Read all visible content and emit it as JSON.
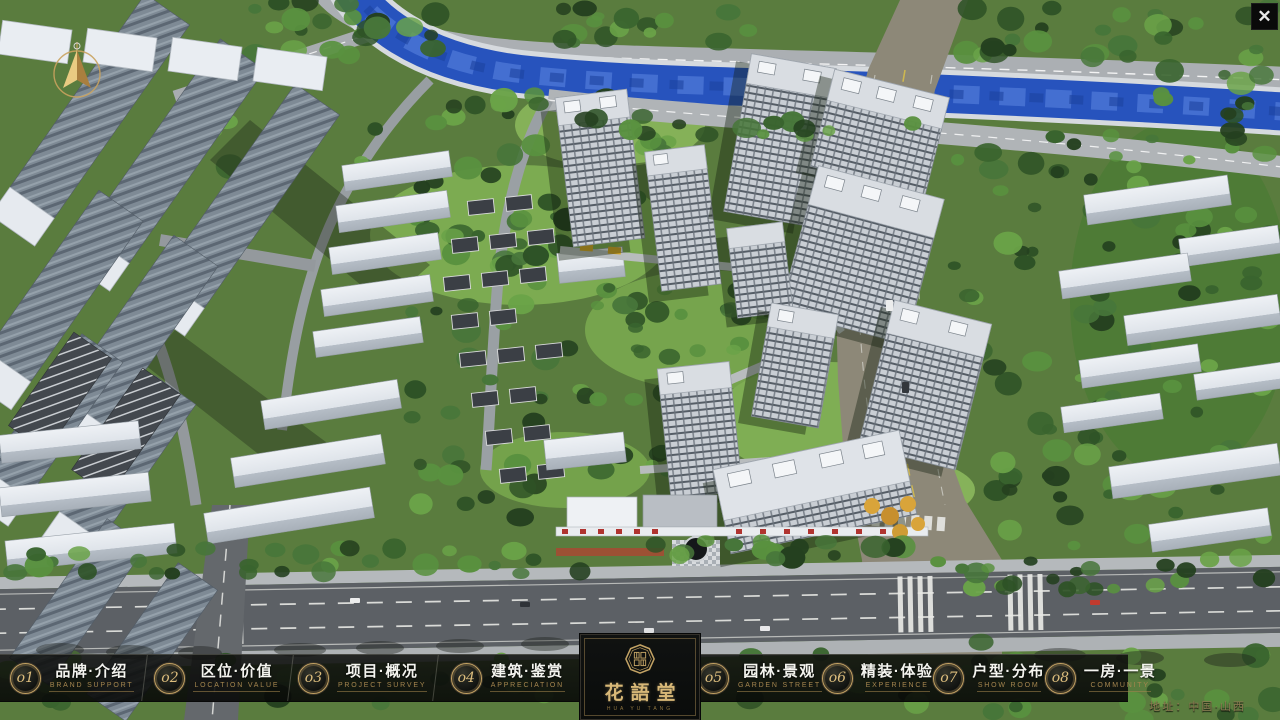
{
  "app": {
    "close_label": "✕"
  },
  "menu": {
    "items": [
      {
        "num": "o1",
        "zh": "品牌·介绍",
        "en": "BRAND SUPPORT"
      },
      {
        "num": "o2",
        "zh": "区位·价值",
        "en": "LOCATION VALUE"
      },
      {
        "num": "o3",
        "zh": "项目·概况",
        "en": "PROJECT SURVEY"
      },
      {
        "num": "o4",
        "zh": "建筑·鉴赏",
        "en": "APPRECIATION"
      },
      {
        "num": "o5",
        "zh": "园林·景观",
        "en": "GARDEN STREET"
      },
      {
        "num": "o6",
        "zh": "精装·体验",
        "en": "EXPERIENCE"
      },
      {
        "num": "o7",
        "zh": "户型·分布",
        "en": "SHOW ROOM"
      },
      {
        "num": "o8",
        "zh": "一房·一景",
        "en": "COMMUNITY"
      }
    ]
  },
  "logo": {
    "title": "花語堂",
    "subtitle": "HUA YU TANG"
  },
  "footer": {
    "address": "地址：中国·山西"
  },
  "colors": {
    "gold_accent": "#c3a263",
    "bar_background": "#0b0c0b",
    "river_blue": "#2753bd",
    "tree_green": "#2f5426",
    "road_gray": "#5c6065"
  }
}
